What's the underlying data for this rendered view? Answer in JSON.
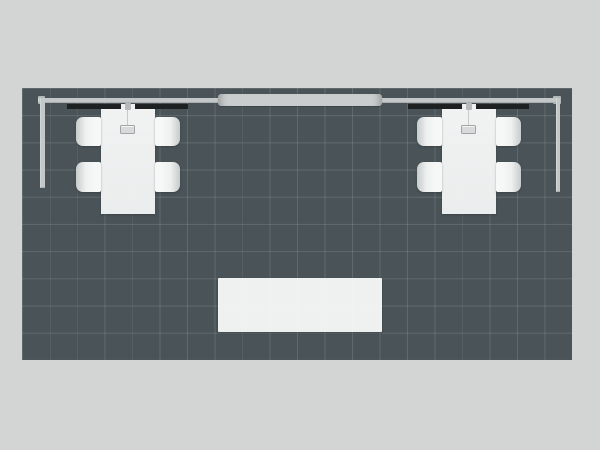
{
  "page": {
    "title": "Trade Show Exhibit Booth — Top View Rendering"
  },
  "colors": {
    "background": "#d3d4d4",
    "floor": "#4a5458",
    "grid_line": "rgba(255,255,255,0.12)",
    "rail": "#c3c7c7",
    "rail_end": "#b2b7b7",
    "canopy": "#c9cdcd",
    "header_strip": "#1e2122",
    "furniture": "#f6f7f7",
    "chair_shade": "#c6cbcb",
    "lamp_fill": "#d6dada",
    "lamp_edge": "#a0a6a6",
    "counter": "rgba(252,253,253,0.93)"
  },
  "scene": {
    "floor": {
      "name": "booth-floor",
      "grid_columns": 20,
      "grid_rows": 10
    },
    "structure": {
      "back_rail": "back-wall-rail",
      "left_rail": "left-side-rail",
      "right_rail": "right-side-rail",
      "canopy": "center-header-beam"
    },
    "furniture": {
      "conference_sets": [
        {
          "name": "left-conference-set",
          "position": "top-left",
          "chairs": 4,
          "pendant_lamp": true,
          "header_graphic": true
        },
        {
          "name": "right-conference-set",
          "position": "top-right",
          "chairs": 4,
          "pendant_lamp": true,
          "header_graphic": true
        }
      ],
      "counter": {
        "name": "center-counter",
        "position": "bottom-center"
      }
    }
  }
}
